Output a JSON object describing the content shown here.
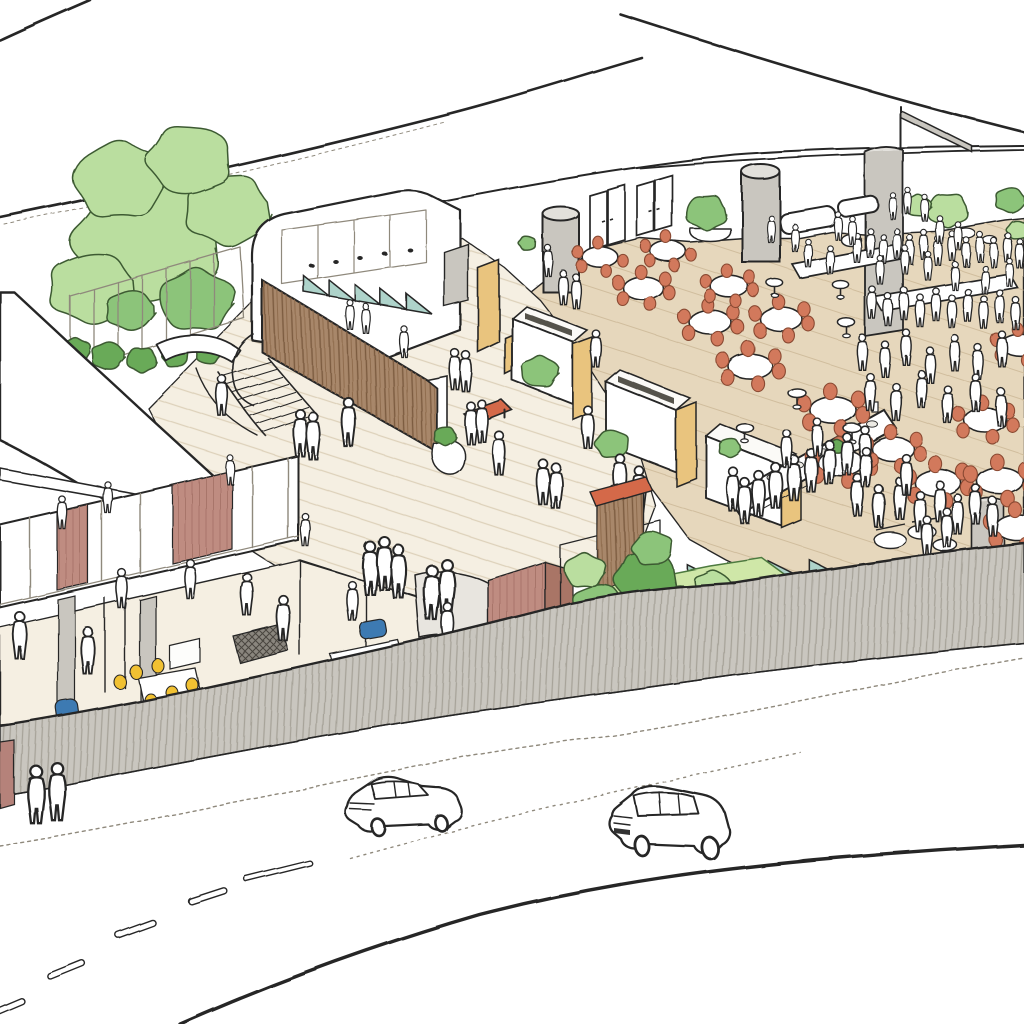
{
  "meta": {
    "description": "Hand-drawn aerial architectural sketch: food hall terrace with round tables, central plaza with timber wall, serving stations, garden berm, hatched perimeter wall, street with two cars",
    "visible_text": "none"
  },
  "palette": {
    "ink": "#272727",
    "pencil": "#8f897c",
    "beige": "#e6d7bc",
    "beigeLine": "#d0bd9d",
    "cream": "#f5efe2",
    "creamLine": "#ddd1ba",
    "gray": "#c9c6bf",
    "grayTop": "#e2e0db",
    "grayHatch": "#a7a399",
    "woodBase": "#a8876a",
    "woodGrain": "#7c5b40",
    "rose": "#bf8c81",
    "roseGrain": "#a8756a",
    "roseDark": "#b5827a",
    "tan": "#e9c47e",
    "teal": "#aed3ca",
    "chair": "#d2795b",
    "chairLine": "#8a4a33",
    "bench": "#d4694a",
    "yellow": "#f1c133",
    "blue": "#3e7ab2",
    "greenLight": "#bade9f",
    "greenMid": "#8cc47a",
    "greenDark": "#69aa58",
    "greenOutline": "#3c5a33",
    "lawn": "#cfe7a8",
    "plate": "#eceae4"
  },
  "objects": {
    "cars": [
      {
        "type": "sedan",
        "x": 342,
        "y": 776
      },
      {
        "type": "wagon",
        "x": 604,
        "y": 782
      }
    ],
    "trees": [
      [
        148,
        240,
        80,
        "light"
      ],
      [
        92,
        288,
        46,
        "light"
      ],
      [
        196,
        300,
        40,
        "mid"
      ],
      [
        228,
        210,
        46,
        "light"
      ],
      [
        120,
        180,
        50,
        "light"
      ],
      [
        190,
        160,
        45,
        "light"
      ],
      [
        130,
        310,
        26,
        "mid"
      ]
    ],
    "bushes_left": [
      [
        75,
        350,
        16,
        "dark"
      ],
      [
        108,
        356,
        18,
        "dark"
      ],
      [
        142,
        360,
        16,
        "dark"
      ],
      [
        175,
        356,
        14,
        "dark"
      ],
      [
        208,
        354,
        13,
        "dark"
      ],
      [
        40,
        688,
        13,
        "dark"
      ]
    ],
    "bushes_site": [
      [
        540,
        372,
        20,
        "mid"
      ],
      [
        612,
        444,
        18,
        "mid"
      ],
      [
        730,
        448,
        12,
        "mid"
      ],
      [
        836,
        446,
        9,
        "dark"
      ],
      [
        528,
        244,
        9,
        "mid"
      ],
      [
        706,
        212,
        22,
        "mid"
      ],
      [
        948,
        210,
        22,
        "light"
      ],
      [
        1010,
        200,
        16,
        "mid"
      ],
      [
        1018,
        230,
        12,
        "light"
      ],
      [
        918,
        206,
        14,
        "light"
      ],
      [
        445,
        436,
        12,
        "dark"
      ]
    ],
    "bushes_garden": [
      [
        558,
        636,
        26,
        "dark"
      ],
      [
        598,
        607,
        30,
        "mid"
      ],
      [
        646,
        578,
        34,
        "dark"
      ],
      [
        688,
        604,
        26,
        "mid"
      ],
      [
        626,
        636,
        24,
        "light"
      ],
      [
        584,
        570,
        22,
        "light"
      ],
      [
        666,
        630,
        20,
        "dark"
      ],
      [
        712,
        586,
        20,
        "light"
      ],
      [
        536,
        664,
        18,
        "dark"
      ],
      [
        724,
        616,
        16,
        "dark"
      ],
      [
        652,
        548,
        22,
        "mid"
      ]
    ],
    "tufts": [
      [
        520,
        660,
        1
      ],
      [
        552,
        672,
        1
      ],
      [
        700,
        625,
        1
      ],
      [
        732,
        600,
        0.9
      ],
      [
        472,
        680,
        0.9
      ],
      [
        598,
        660,
        0.8
      ]
    ],
    "tables": [
      [
        600,
        257,
        0.85
      ],
      [
        668,
        251,
        0.85
      ],
      [
        643,
        288,
        0.95
      ],
      [
        710,
        322,
        1.0
      ],
      [
        729,
        286,
        0.9
      ],
      [
        781,
        319,
        1.0
      ],
      [
        750,
        366,
        1.05
      ],
      [
        833,
        410,
        1.1
      ],
      [
        841,
        463,
        1.1
      ],
      [
        893,
        449,
        1.0
      ],
      [
        938,
        483,
        1.1
      ],
      [
        1000,
        481,
        1.1
      ],
      [
        1018,
        528,
        1.05
      ],
      [
        985,
        420,
        1.0
      ],
      [
        1020,
        345,
        0.9
      ]
    ],
    "cocktail_tables": [
      [
        775,
        283,
        0.9
      ],
      [
        841,
        285,
        0.9
      ],
      [
        846,
        322,
        0.95
      ],
      [
        797,
        393,
        1.0
      ],
      [
        852,
        428,
        1.0
      ],
      [
        745,
        428,
        0.95
      ]
    ],
    "sawtooth": [
      {
        "x1": 304,
        "y1": 292,
        "x2": 432,
        "y2": 314,
        "teeth": 5,
        "h": 16,
        "target": "gen-saw-upper"
      },
      {
        "x1": 606,
        "y1": 590,
        "x2": 850,
        "y2": 580,
        "teeth": 6,
        "h": 22,
        "target": "gen-saw-lower"
      }
    ],
    "people_site": [
      [
        222,
        400,
        1.3
      ],
      [
        300,
        438,
        1.5
      ],
      [
        313,
        441,
        1.5
      ],
      [
        349,
        428,
        1.55
      ],
      [
        455,
        374,
        1.3
      ],
      [
        466,
        376,
        1.3
      ],
      [
        471,
        428,
        1.35
      ],
      [
        482,
        426,
        1.35
      ],
      [
        499,
        458,
        1.4
      ],
      [
        543,
        487,
        1.45
      ],
      [
        556,
        491,
        1.45
      ],
      [
        370,
        574,
        1.7
      ],
      [
        384,
        569,
        1.7
      ],
      [
        398,
        577,
        1.7
      ],
      [
        432,
        599,
        1.75
      ],
      [
        447,
        593,
        1.75
      ],
      [
        350,
        318,
        0.95
      ],
      [
        366,
        322,
        0.95
      ],
      [
        404,
        345,
        1.0
      ],
      [
        596,
        353,
        1.2
      ],
      [
        563,
        291,
        1.1
      ],
      [
        576,
        295,
        1.1
      ],
      [
        548,
        264,
        1.0
      ],
      [
        733,
        494,
        1.4
      ],
      [
        745,
        506,
        1.45
      ],
      [
        759,
        499,
        1.45
      ],
      [
        776,
        491,
        1.45
      ],
      [
        794,
        483,
        1.45
      ],
      [
        811,
        475,
        1.4
      ],
      [
        829,
        467,
        1.4
      ],
      [
        847,
        459,
        1.35
      ],
      [
        865,
        451,
        1.3
      ],
      [
        787,
        453,
        1.2
      ],
      [
        817,
        441,
        1.2
      ],
      [
        588,
        432,
        1.35
      ],
      [
        620,
        482,
        1.45
      ],
      [
        639,
        494,
        1.45
      ],
      [
        857,
        251,
        0.95
      ],
      [
        870,
        246,
        0.95
      ],
      [
        883,
        252,
        0.95
      ],
      [
        897,
        247,
        0.95
      ],
      [
        910,
        253,
        0.95
      ],
      [
        924,
        248,
        0.95
      ],
      [
        938,
        254,
        0.95
      ],
      [
        952,
        249,
        0.95
      ],
      [
        966,
        255,
        0.95
      ],
      [
        980,
        250,
        0.95
      ],
      [
        994,
        256,
        0.95
      ],
      [
        1008,
        251,
        0.95
      ],
      [
        1020,
        257,
        0.95
      ],
      [
        872,
        306,
        1.05
      ],
      [
        888,
        313,
        1.05
      ],
      [
        904,
        307,
        1.05
      ],
      [
        920,
        314,
        1.05
      ],
      [
        936,
        308,
        1.05
      ],
      [
        952,
        315,
        1.05
      ],
      [
        968,
        309,
        1.05
      ],
      [
        984,
        316,
        1.05
      ],
      [
        1000,
        310,
        1.05
      ],
      [
        1016,
        317,
        1.05
      ],
      [
        862,
        356,
        1.15
      ],
      [
        885,
        363,
        1.15
      ],
      [
        906,
        351,
        1.15
      ],
      [
        930,
        369,
        1.15
      ],
      [
        955,
        357,
        1.15
      ],
      [
        978,
        366,
        1.15
      ],
      [
        1002,
        353,
        1.15
      ],
      [
        870,
        396,
        1.2
      ],
      [
        896,
        406,
        1.2
      ],
      [
        921,
        393,
        1.2
      ],
      [
        948,
        409,
        1.2
      ],
      [
        976,
        397,
        1.2
      ],
      [
        1001,
        411,
        1.2
      ],
      [
        858,
        500,
        1.35
      ],
      [
        879,
        511,
        1.35
      ],
      [
        900,
        503,
        1.35
      ],
      [
        920,
        516,
        1.3
      ],
      [
        940,
        506,
        1.3
      ],
      [
        958,
        519,
        1.28
      ],
      [
        976,
        509,
        1.28
      ],
      [
        993,
        521,
        1.25
      ],
      [
        866,
        472,
        1.3
      ],
      [
        906,
        479,
        1.3
      ],
      [
        927,
        540,
        1.25
      ],
      [
        947,
        532,
        1.25
      ],
      [
        893,
        209,
        0.85
      ],
      [
        908,
        204,
        0.85
      ],
      [
        925,
        211,
        0.85
      ],
      [
        852,
        233,
        0.9
      ],
      [
        838,
        229,
        0.9
      ],
      [
        940,
        233,
        0.9
      ],
      [
        958,
        239,
        0.9
      ],
      [
        905,
        263,
        0.92
      ],
      [
        928,
        269,
        0.92
      ],
      [
        880,
        273,
        0.92
      ],
      [
        955,
        279,
        0.92
      ],
      [
        985,
        283,
        0.92
      ],
      [
        1010,
        276,
        0.9
      ],
      [
        830,
        263,
        0.92
      ],
      [
        808,
        256,
        0.9
      ],
      [
        795,
        241,
        0.88
      ],
      [
        771,
        232,
        0.88
      ],
      [
        20,
        641,
        1.5
      ],
      [
        88,
        656,
        1.5
      ],
      [
        122,
        593,
        1.25
      ],
      [
        190,
        583,
        1.25
      ],
      [
        247,
        599,
        1.35
      ],
      [
        283,
        623,
        1.45
      ],
      [
        305,
        533,
        1.05
      ],
      [
        62,
        516,
        1.05
      ],
      [
        108,
        501,
        1.0
      ],
      [
        230,
        473,
        0.95
      ],
      [
        448,
        629,
        1.35
      ],
      [
        352,
        605,
        1.25
      ]
    ],
    "people_street": [
      [
        36,
        801,
        1.85
      ],
      [
        57,
        798,
        1.85
      ]
    ]
  }
}
